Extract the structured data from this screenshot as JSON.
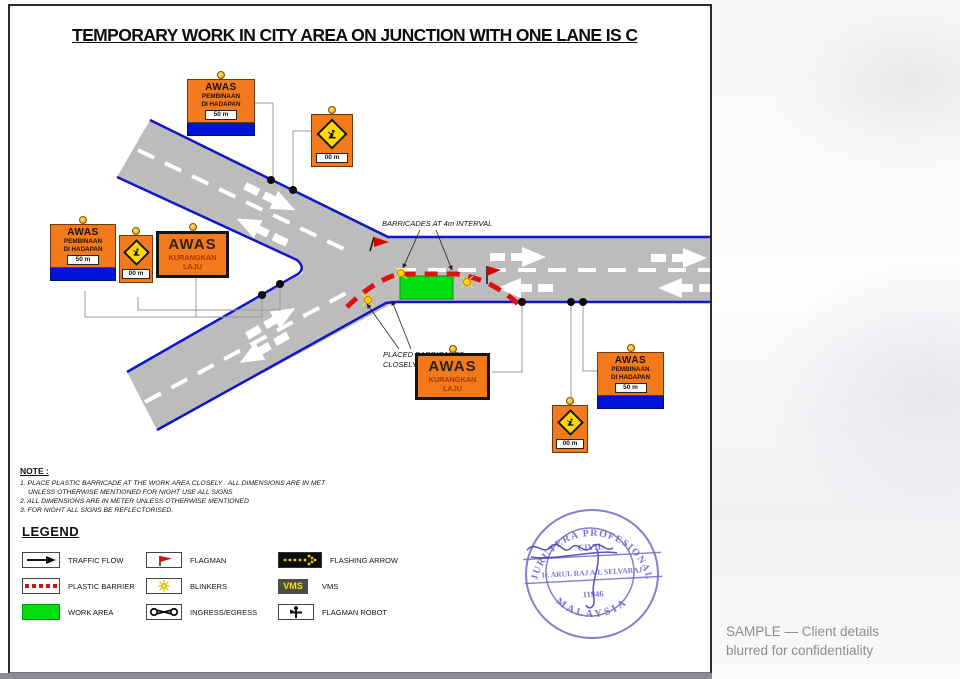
{
  "title": "TEMPORARY WORK IN CITY AREA ON JUNCTION WITH ONE LANE IS C",
  "signs": {
    "awas_pembinaan": {
      "title": "AWAS",
      "line2": "PEMBINAAN",
      "line3": "DI HADAPAN",
      "distance": "50 m"
    },
    "awas_kurangkan": {
      "title": "AWAS",
      "subtitle": "KURANGKAN LAJU"
    },
    "worker_sign_distance": "00 m"
  },
  "annotations": {
    "barricade_interval": "BARRICADES AT 4m INTERVAL",
    "placed_line1": "PLACED BARRICADES",
    "placed_line2": "CLOSELY"
  },
  "note": {
    "heading": "NOTE :",
    "line1": "1. PLACE PLASTIC BARRICADE AT THE WORK AREA CLOSELY . ALL DIMENSIONS ARE IN MET",
    "line2": "UNLESS OTHERWISE MENTIONED FOR NIGHT USE ALL SIGNS",
    "line3": "2. ALL DIMENSIONS ARE IN METER UNLESS OTHERWISE MENTIONED",
    "line4": "3. FOR NIGHT ALL SIGNS BE REFLECTORISED."
  },
  "legend": {
    "heading": "LEGEND",
    "vms_text": "VMS",
    "items": [
      {
        "name": "traffic-flow",
        "label": "TRAFFIC FLOW"
      },
      {
        "name": "flagman",
        "label": "FLAGMAN"
      },
      {
        "name": "flashing-arrow",
        "label": "FLASHING ARROW"
      },
      {
        "name": "plastic-barrier",
        "label": "PLASTIC BARRIER"
      },
      {
        "name": "blinkers",
        "label": "BLINKERS"
      },
      {
        "name": "vms",
        "label": "VMS"
      },
      {
        "name": "work-area",
        "label": "WORK AREA"
      },
      {
        "name": "ingress-egress",
        "label": "INGRESS/EGRESS"
      },
      {
        "name": "flagman-robot",
        "label": "FLAGMAN ROBOT"
      }
    ]
  },
  "stamp": {
    "arc_top": "JURUTERA  PROFESIONAL",
    "field": "CIVIL",
    "name": "Ir. ARUL RAJ A/L SELVARAJ",
    "number": "11946",
    "arc_bottom": "MALAYSIA"
  },
  "watermark": {
    "line1": "SAMPLE — Client details",
    "line2": "blurred for confidentiality"
  },
  "colors": {
    "road": "#bcbcbc",
    "road_edge": "#1414c8",
    "sign_orange": "#f2791c",
    "work_area": "#00dd11",
    "barrier_red": "#dd1111",
    "stamp_blue": "#6a6ac8"
  }
}
